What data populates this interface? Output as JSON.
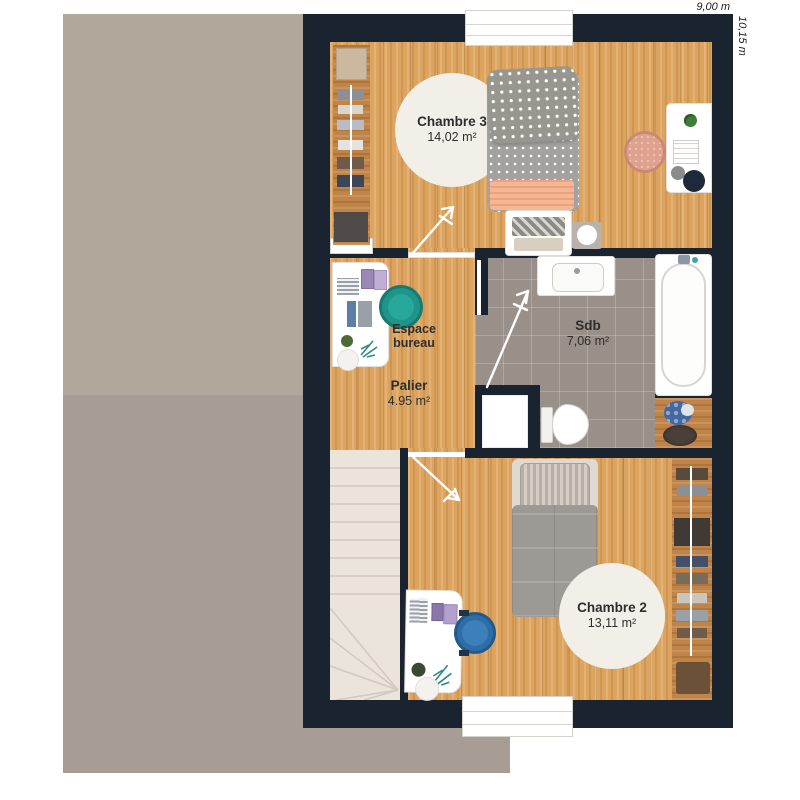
{
  "dimensions": {
    "width": "9,00 m",
    "depth": "10,15 m"
  },
  "rooms": {
    "chambre3": {
      "name": "Chambre 3",
      "area": "14,02 m²"
    },
    "espace_bureau": {
      "name": "Espace bureau"
    },
    "palier": {
      "name": "Palier",
      "area": "4.95 m²"
    },
    "sdb": {
      "name": "Sdb",
      "area": "7,06 m²"
    },
    "chambre2": {
      "name": "Chambre 2",
      "area": "13,11 m²"
    }
  },
  "colors": {
    "wall": "#1a2330",
    "wood": "#dda45f",
    "wood_dark": "#c08448",
    "tile": "#99908a",
    "roof_upper": "#b2a79b",
    "roof_lower": "#a79d95",
    "stairs": "#eae4db",
    "rug": "#f2efe9",
    "chair_teal": "#1f9489",
    "chair_blue": "#2e6ea6",
    "chair_salmon": "#dfa28e",
    "peach": "#f5b293"
  }
}
